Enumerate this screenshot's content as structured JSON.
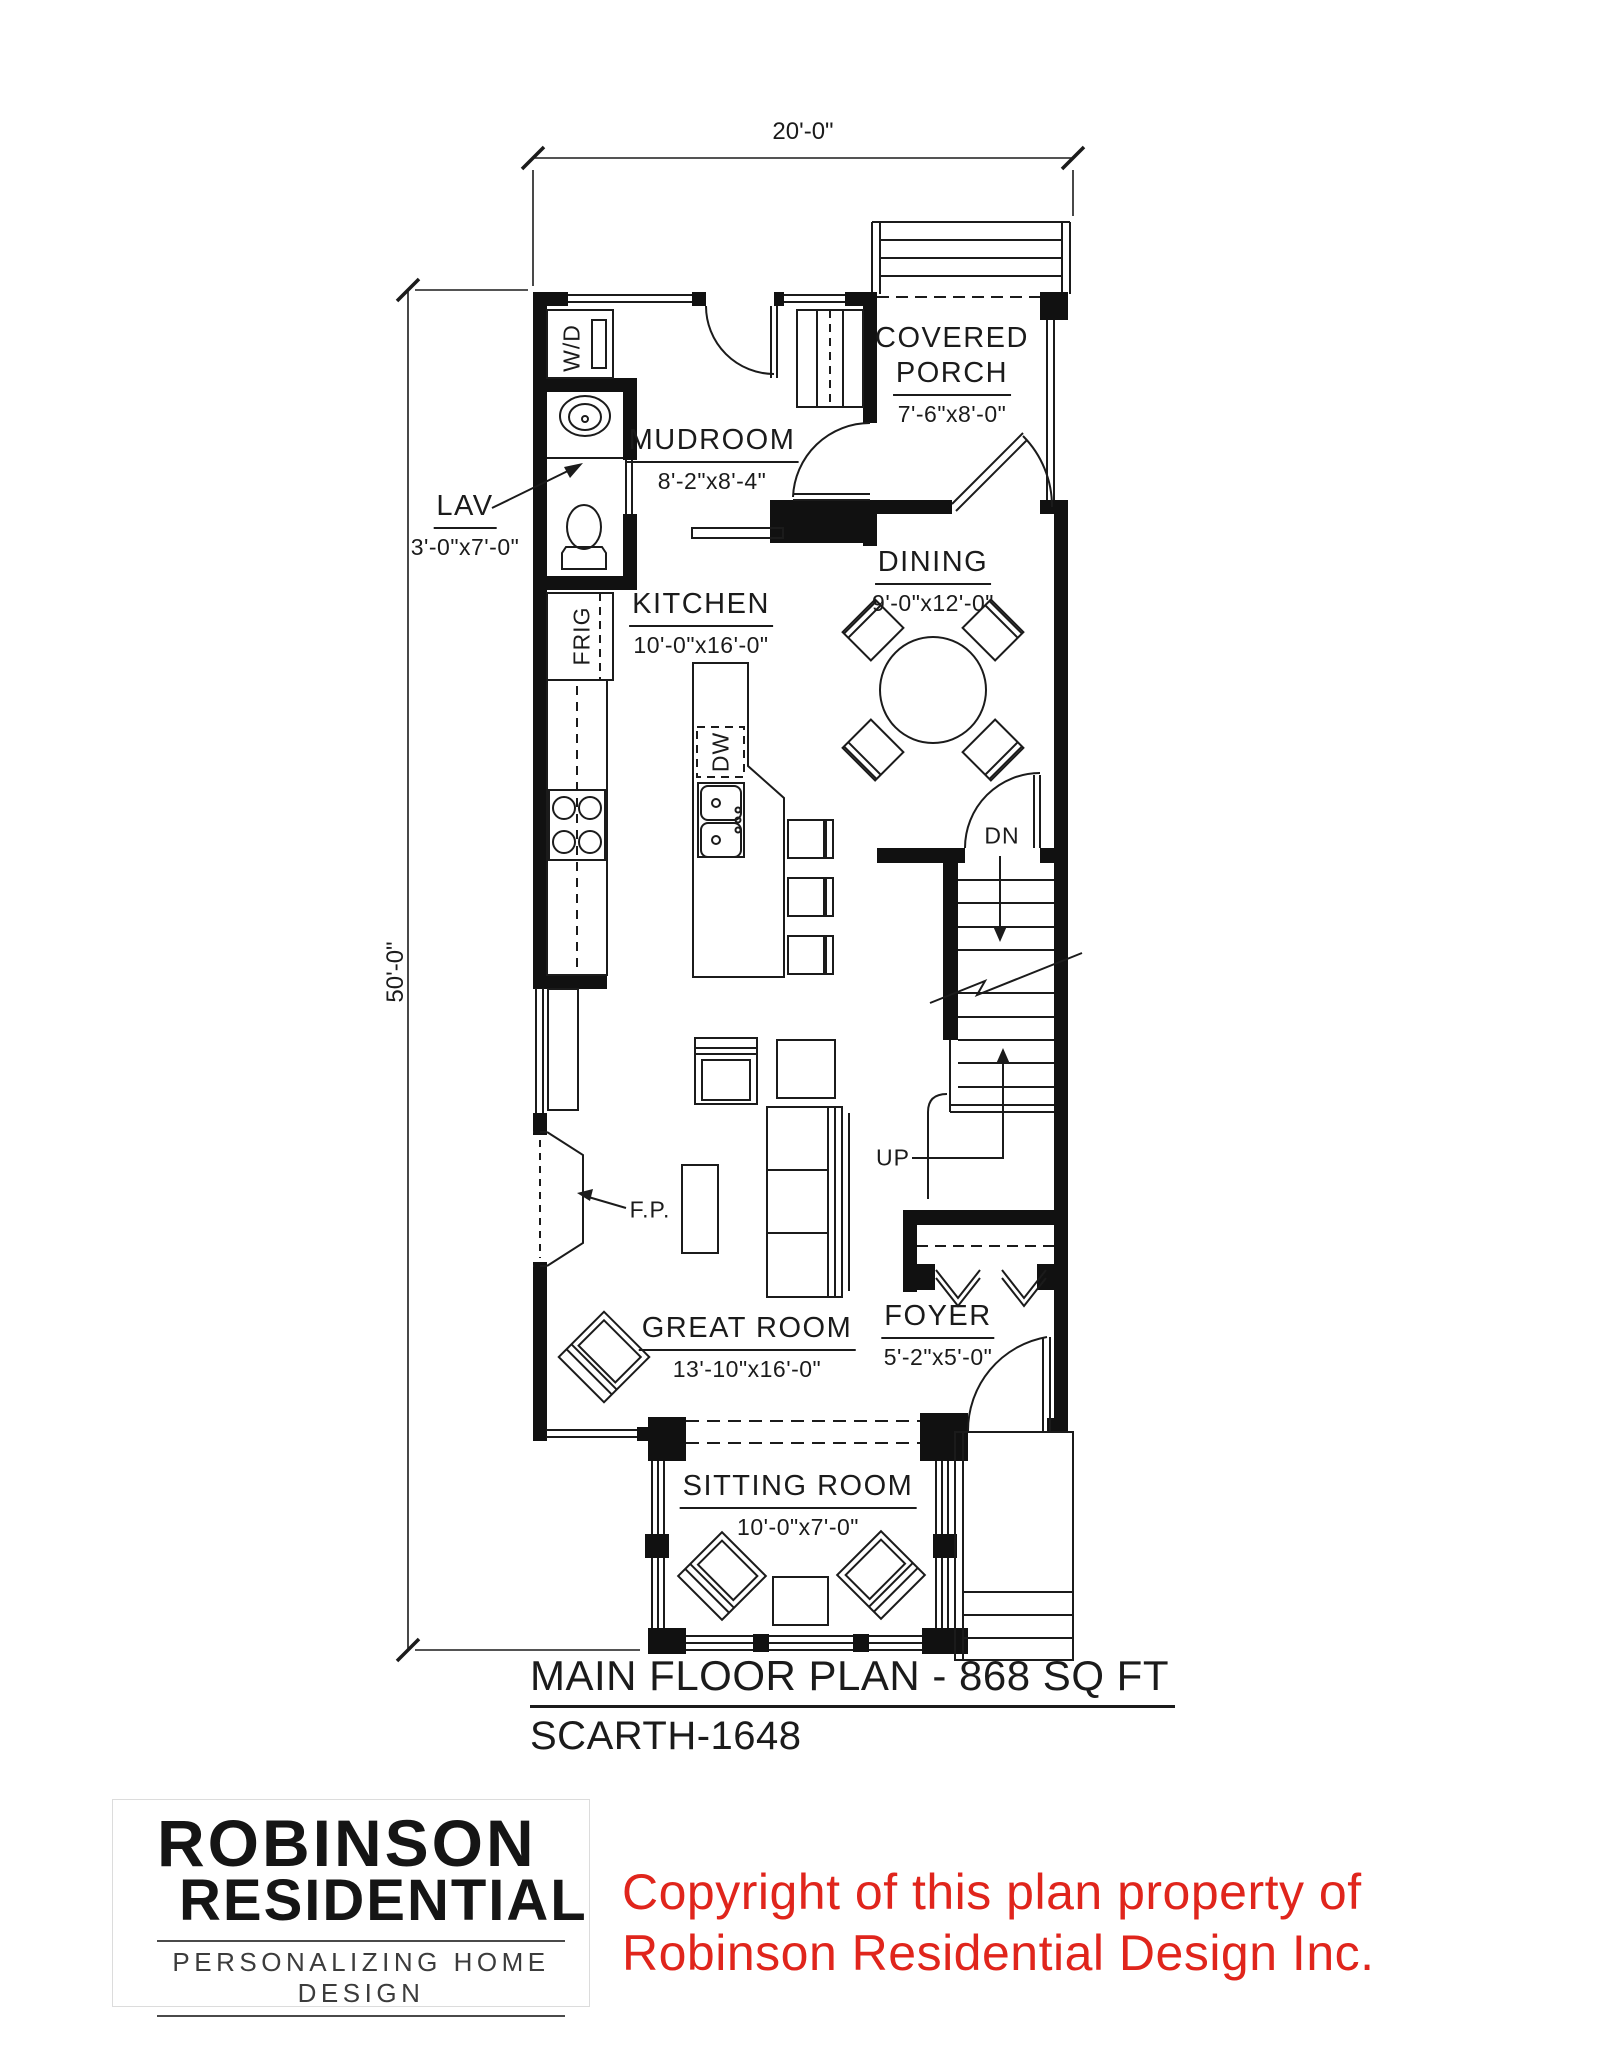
{
  "plan": {
    "sheet_title": "MAIN FLOOR PLAN - 868 SQ FT",
    "plan_number": "SCARTH-1648",
    "overall_width": "20'-0\"",
    "overall_depth": "50'-0\"",
    "rooms": [
      {
        "id": "covered-porch",
        "name": "COVERED PORCH",
        "name_line1": "COVERED",
        "name_line2": "PORCH",
        "size": "7'-6\"x8'-0\""
      },
      {
        "id": "mudroom",
        "name": "MUDROOM",
        "size": "8'-2\"x8'-4\""
      },
      {
        "id": "lav",
        "name": "LAV",
        "size": "3'-0\"x7'-0\""
      },
      {
        "id": "kitchen",
        "name": "KITCHEN",
        "size": "10'-0\"x16'-0\""
      },
      {
        "id": "dining",
        "name": "DINING",
        "size": "9'-0\"x12'-0\""
      },
      {
        "id": "great-room",
        "name": "GREAT ROOM",
        "size": "13'-10\"x16'-0\""
      },
      {
        "id": "foyer",
        "name": "FOYER",
        "size": "5'-2\"x5'-0\""
      },
      {
        "id": "sitting-room",
        "name": "SITTING ROOM",
        "size": "10'-0\"x7'-0\""
      }
    ],
    "fixture_labels": {
      "washer_dryer": "W/D",
      "fridge": "FRIG",
      "dishwasher": "DW",
      "fireplace": "F.P.",
      "stair_down": "DN",
      "stair_up": "UP"
    }
  },
  "branding": {
    "logo_line1": "ROBINSON",
    "logo_line2": "RESIDENTIAL",
    "logo_tagline": "PERSONALIZING HOME DESIGN",
    "copyright_line1": "Copyright of this plan property of",
    "copyright_line2": "Robinson Residential Design Inc.",
    "copyright_color": "#e0251c"
  },
  "colors": {
    "line": "#1b1b1b",
    "wall": "#111111",
    "background": "#ffffff"
  }
}
